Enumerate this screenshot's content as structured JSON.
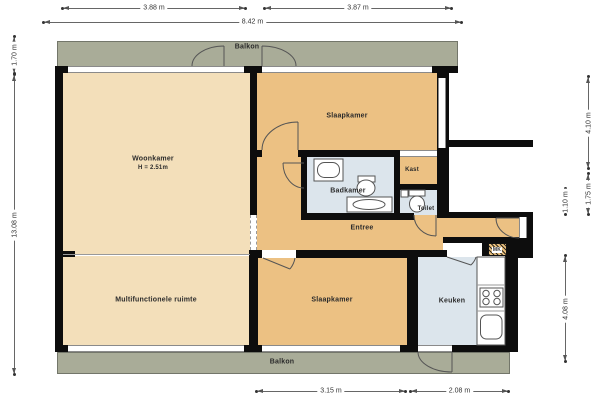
{
  "plan": {
    "rooms": {
      "balkon_top": "Balkon",
      "balkon_bottom": "Balkon",
      "woonkamer": "Woonkamer",
      "woonkamer_ceiling": "H = 2.51m",
      "slaapkamer_top": "Slaapkamer",
      "slaapkamer_bottom": "Slaapkamer",
      "kast": "Kast",
      "badkamer": "Badkamer",
      "toilet": "Toilet",
      "entree": "Entree",
      "meterkast": "MK",
      "multifunctionele_ruimte": "Multifunctionele ruimte",
      "keuken": "Keuken"
    },
    "dimensions": {
      "top_left": "3.88 m",
      "top_right": "3.87 m",
      "top_total": "8.42 m",
      "left_balkon": "1.70 m",
      "left_total": "13.08 m",
      "right_top": "4.10 m",
      "right_mid": "1.75 m",
      "right_inner": "1.10 m",
      "right_bottom": "4.08 m",
      "bottom_slaapkamer": "3.15 m",
      "bottom_keuken": "2.08 m"
    },
    "fixtures": [
      "bathtub",
      "washbasin",
      "vanity-counter",
      "toilet",
      "corner-sink",
      "stove",
      "kitchen-sink",
      "kitchen-counter"
    ],
    "colors": {
      "balcony": "#a9ac98",
      "living": "#f3dfba",
      "bedroom": "#ecc183",
      "wet_room": "#dce5ec",
      "wall": "#0d0d0d"
    }
  }
}
